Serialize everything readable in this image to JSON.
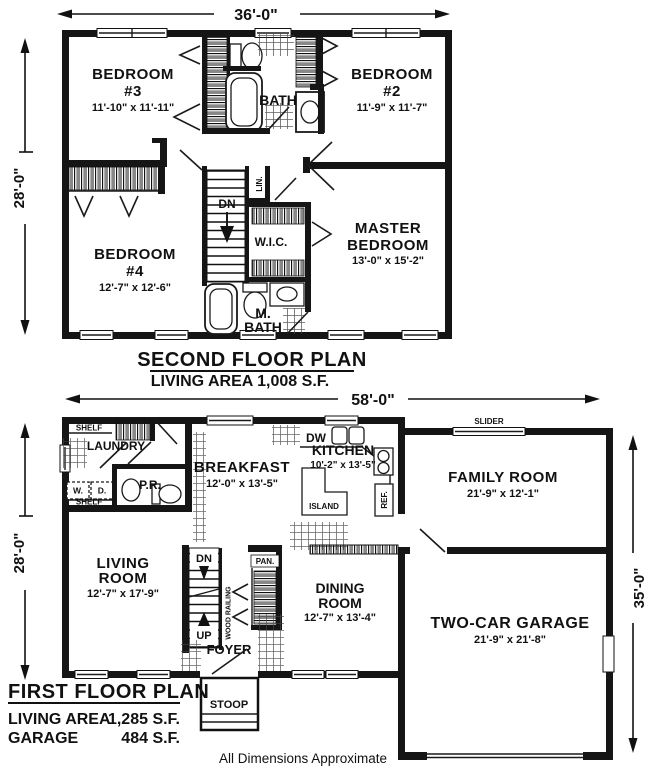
{
  "second_floor": {
    "dim_top": "36'-0\"",
    "dim_left": "28'-0\"",
    "bedroom3_l1": "BEDROOM",
    "bedroom3_l2": "#3",
    "bedroom3_dims": "11'-10\" x 11'-11\"",
    "bath": "BATH",
    "bedroom2_l1": "BEDROOM",
    "bedroom2_l2": "#2",
    "bedroom2_dims": "11'-9\" x 11'-7\"",
    "master_l1": "MASTER",
    "master_l2": "BEDROOM",
    "master_dims": "13'-0\" x 15'-2\"",
    "bedroom4_l1": "BEDROOM",
    "bedroom4_l2": "#4",
    "bedroom4_dims": "12'-7\" x 12'-6\"",
    "wic": "W.I.C.",
    "lin": "LIN.",
    "dn": "DN",
    "mbath_l1": "M.",
    "mbath_l2": "BATH",
    "title": "SECOND FLOOR PLAN",
    "subtitle": "LIVING AREA 1,008 S.F."
  },
  "first_floor": {
    "dim_top": "58'-0\"",
    "dim_left": "28'-0\"",
    "dim_right": "35'-0\"",
    "shelf_top": "SHELF",
    "laundry": "LAUNDRY",
    "washer": "W.",
    "dryer": "D.",
    "shelf_bottom": "SHELF",
    "pr": "P.R.",
    "breakfast": "BREAKFAST",
    "breakfast_dims": "12'-0\" x 13'-5\"",
    "kitchen": "KITCHEN",
    "kitchen_dims": "10'-2\" x 13'-5\"",
    "dw": "DW",
    "island": "ISLAND",
    "ref": "REF.",
    "slider": "SLIDER",
    "family": "FAMILY ROOM",
    "family_dims": "21'-9\" x 12'-1\"",
    "living_l1": "LIVING",
    "living_l2": "ROOM",
    "living_dims": "12'-7\" x 17'-9\"",
    "dn": "DN",
    "up": "UP",
    "wood_railing": "WOOD RAILING",
    "pan": "PAN.",
    "dining_l1": "DINING",
    "dining_l2": "ROOM",
    "dining_dims": "12'-7\" x 13'-4\"",
    "foyer": "FOYER",
    "stoop": "STOOP",
    "garage": "TWO-CAR GARAGE",
    "garage_dims": "21'-9\" x 21'-8\"",
    "title": "FIRST FLOOR PLAN",
    "living_area_label": "LIVING AREA",
    "living_area_value": "1,285 S.F.",
    "garage_label": "GARAGE",
    "garage_value": "484 S.F."
  },
  "footer": "All Dimensions Approximate"
}
